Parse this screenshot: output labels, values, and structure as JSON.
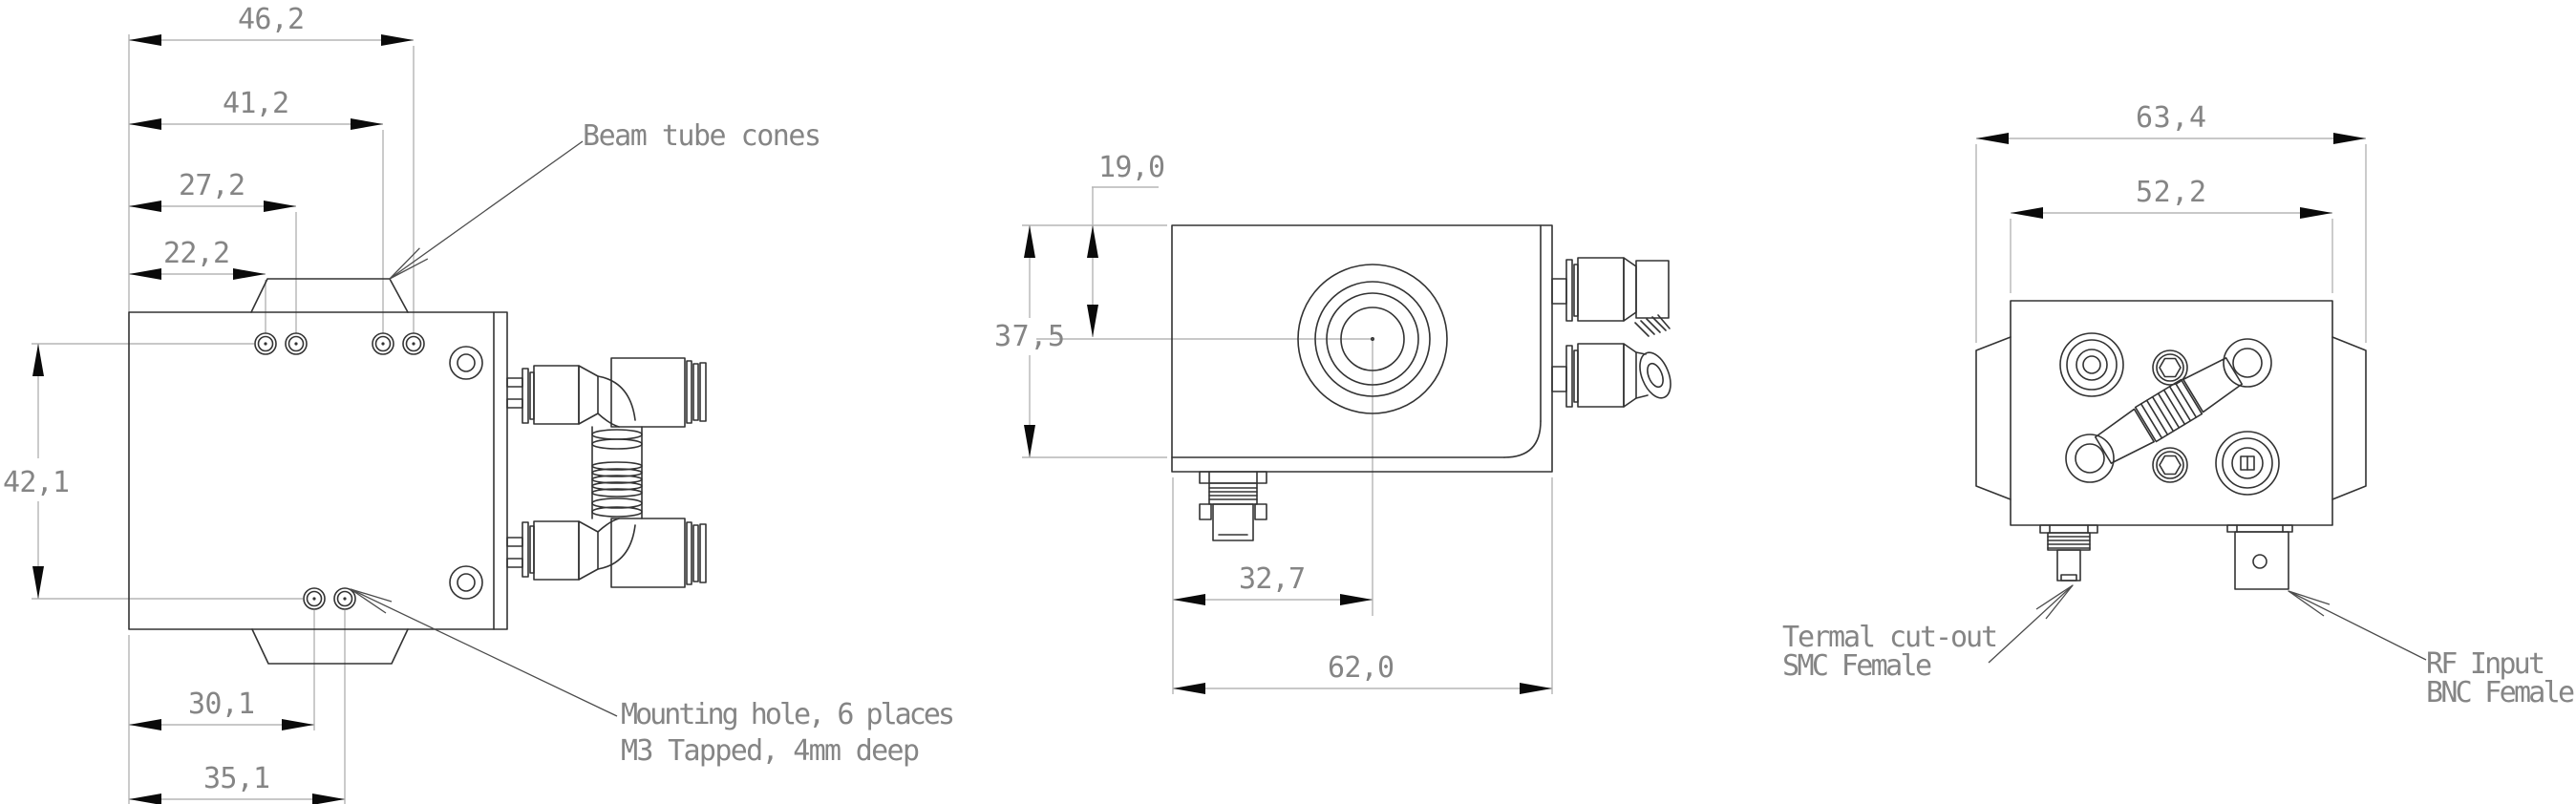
{
  "drawing_title": "Acousto-optic device outline drawing, three views",
  "colors": {
    "background": "#ffffff",
    "part_line": "#333333",
    "dimension_line": "#b5b5b5",
    "dimension_text": "#858585",
    "arrowhead": "#0a0a0a"
  },
  "dims": {
    "side": {
      "d46": "46,2",
      "d41": "41,2",
      "d27": "27,2",
      "d22": "22,2",
      "height": "42,1",
      "b30": "30,1",
      "b35": "35,1"
    },
    "front": {
      "center_from_top": "19,0",
      "height": "37,5",
      "center_from_left": "32,7",
      "width": "62,0"
    },
    "end": {
      "overall_width": "63,4",
      "body_width": "52,2"
    }
  },
  "labels": {
    "beam_cones": "Beam tube cones",
    "mounting_line1": "Mounting hole, 6 places",
    "mounting_line2": "M3 Tapped, 4mm deep",
    "thermal_line1": "Termal cut-out",
    "thermal_line2": "SMC Female",
    "rf_line1": "RF Input",
    "rf_line2": "BNC Female"
  }
}
